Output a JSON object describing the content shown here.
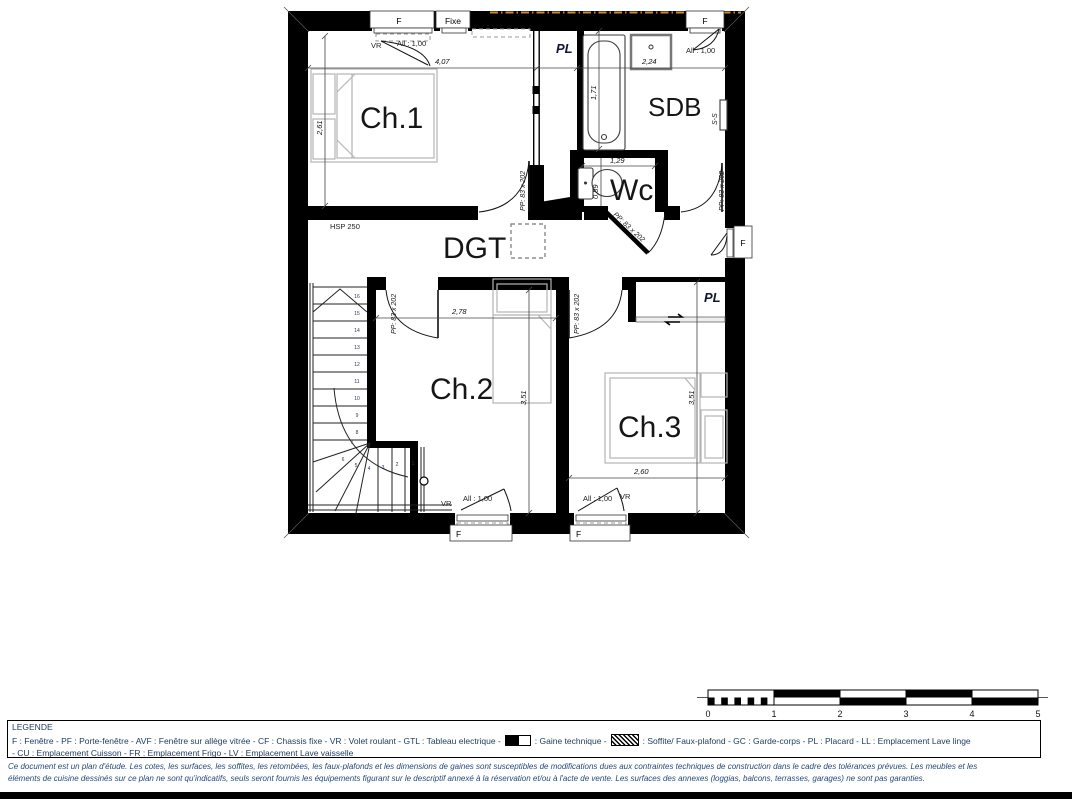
{
  "plan": {
    "room_labels": {
      "ch1": "Ch.1",
      "sdb": "SDB",
      "wc": "Wc",
      "dgt": "DGT",
      "ch2": "Ch.2",
      "ch3": "Ch.3"
    },
    "annotations": {
      "pl": "PL",
      "ss": "S-S",
      "hsp": "HSP 250",
      "pp_door": "PP: 83 x 202",
      "vr": "VR",
      "allege": "All : 1,00",
      "f": "F",
      "fixe": "Fixe"
    },
    "dimensions": {
      "ch1_width": "4,07",
      "ch1_height": "2,61",
      "sdb_width": "2,24",
      "bath_length": "1,71",
      "wc_width": "1,29",
      "wc_depth": "0,89",
      "ch2_width": "2,78",
      "ch2_height": "3,51",
      "ch3_height": "3,51",
      "ch3_width": "2,60"
    },
    "stairs": {
      "steps": [
        "16",
        "15",
        "14",
        "13",
        "12",
        "11",
        "10",
        "9",
        "8",
        "7",
        "6",
        "5",
        "4",
        "3",
        "2",
        "1"
      ]
    }
  },
  "scale_bar": {
    "ticks": [
      "0",
      "1",
      "2",
      "3",
      "4",
      "5"
    ]
  },
  "legend": {
    "title": "LEGENDE",
    "line1_part1": "F : Fenêtre - PF : Porte-fenêtre - AVF : Fenêtre sur allège vitrée - CF : Chassis fixe - VR : Volet roulant - GTL : Tableau electrique -",
    "line1_part2": ": Gaine technique -",
    "line1_part3": ": Soffite/ Faux-plafond - GC : Garde-corps - PL : Placard - LL : Emplacement Lave linge",
    "line2": "- CU : Emplacement Cuisson - FR : Emplacement Frigo - LV : Emplacement Lave vaisselle"
  },
  "disclaimer": {
    "line1": "Ce document est un plan d'étude. Les cotes, les surfaces, les soffites, les retombées, les faux-plafonds et les dimensions de gaines sont susceptibles de modifications dues aux contraintes techniques de construction dans le cadre des tolérances prévues. Les meubles et les",
    "line2": "éléments de cuisine dessinés sur ce plan ne sont qu'indicatifs, seuls seront fournis les équipements figurant sur le descriptif annexé à la réservation et/ou à l'acte de vente. Les surfaces des annexes (loggias, balcons, terrasses, garages) ne sont pas garanties."
  },
  "colors": {
    "wall": "#000000",
    "furniture": "#b5b5b5",
    "legend_text": "#1c3a5e",
    "roof_line": "#cf8a2e"
  }
}
